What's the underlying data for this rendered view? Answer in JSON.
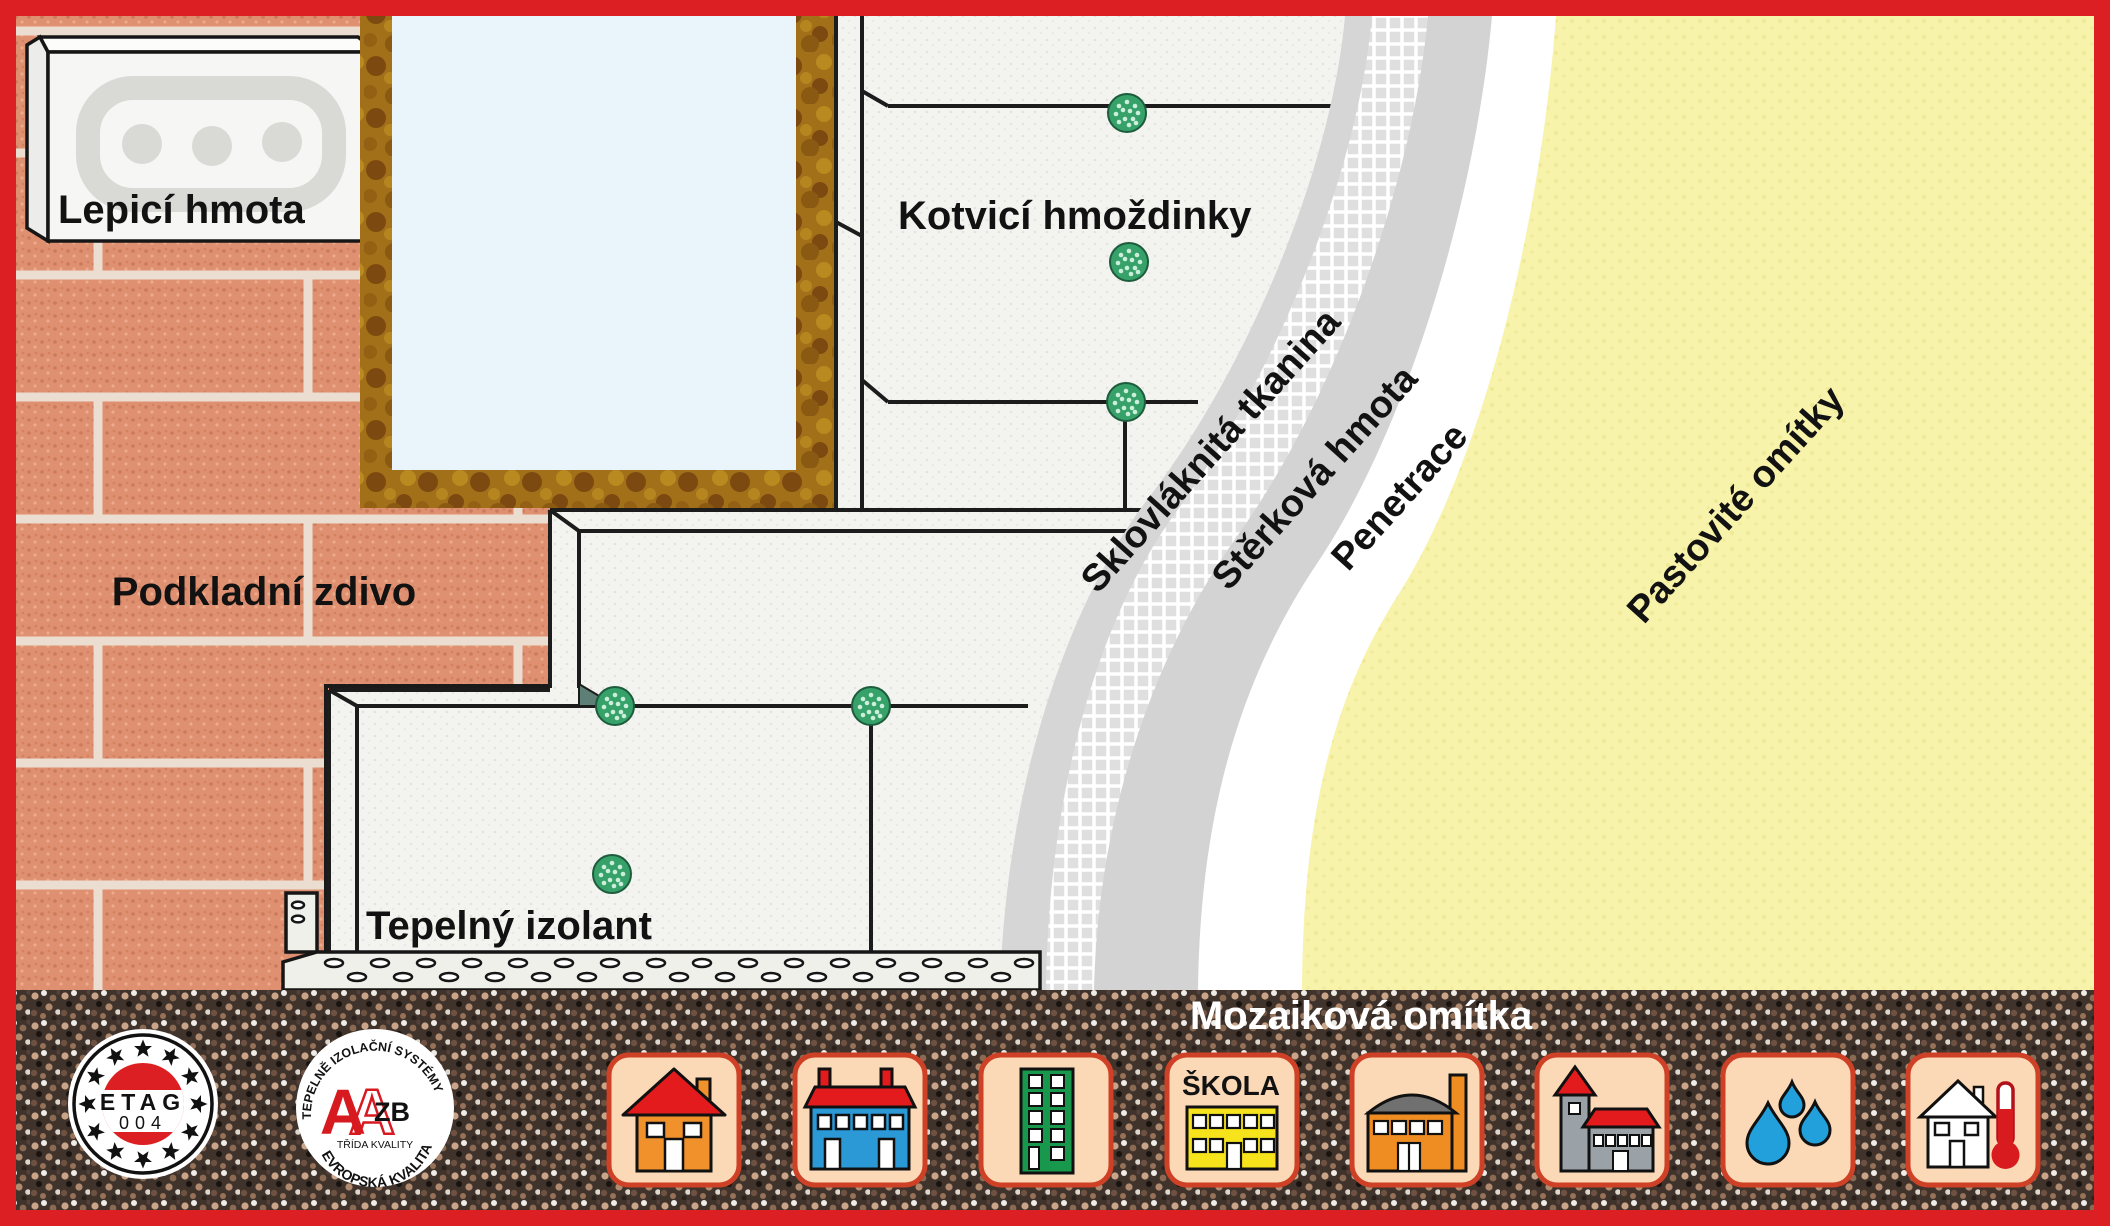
{
  "title": "Zateplovací systém – schéma vrstev (ETICS)",
  "labels": {
    "lepici_hmota": "Lepicí hmota",
    "podkladni_zdivo": "Podkladní zdivo",
    "kotvici_hmozdinky": "Kotvicí hmoždinky",
    "tepelny_izolant": "Tepelný izolant",
    "sklovlaknita_tkanina": "Sklovláknitá tkanina",
    "sterkova_hmota": "Stěrková hmota",
    "penetrace": "Penetrace",
    "pastovite_omitky": "Pastovité omítky",
    "mozaikova_omitka": "Mozaiková omítka"
  },
  "logos": {
    "etag": {
      "line1": "ETAG",
      "line2": "004"
    },
    "azb": {
      "top": "TEPELNĚ IZOLAČNÍ SYSTÉMY",
      "bottom": "EVROPSKÁ KVALITA",
      "letter_a": "A",
      "letter_a2": "A",
      "zb": "ZB",
      "sub": "TŘÍDA KVALITY"
    }
  },
  "icons": [
    {
      "name": "family-house-icon"
    },
    {
      "name": "apartment-house-icon"
    },
    {
      "name": "high-rise-icon"
    },
    {
      "name": "school-icon",
      "label": "ŠKOLA"
    },
    {
      "name": "factory-icon"
    },
    {
      "name": "church-icon"
    },
    {
      "name": "water-drops-icon"
    },
    {
      "name": "house-thermometer-icon"
    }
  ],
  "colors": {
    "border_red": "#dc1f22",
    "brick": "#de9070",
    "mortar": "#ecddd1",
    "eps_white": "#f3f3f0",
    "window_frame_brown": "#a3701a",
    "glass_blue": "#e9f4fb",
    "anchor_green": "#36a169",
    "base_coat_gray": "#d6d6d6",
    "mesh_gray": "#dfdfdf",
    "primer_white": "#ffffff",
    "paste_plaster_yellow": "#f7f3aa",
    "mosaic_dark": "#40332b",
    "icon_tile_bg": "#fbd8b6",
    "icon_tile_border": "#cf4127"
  }
}
